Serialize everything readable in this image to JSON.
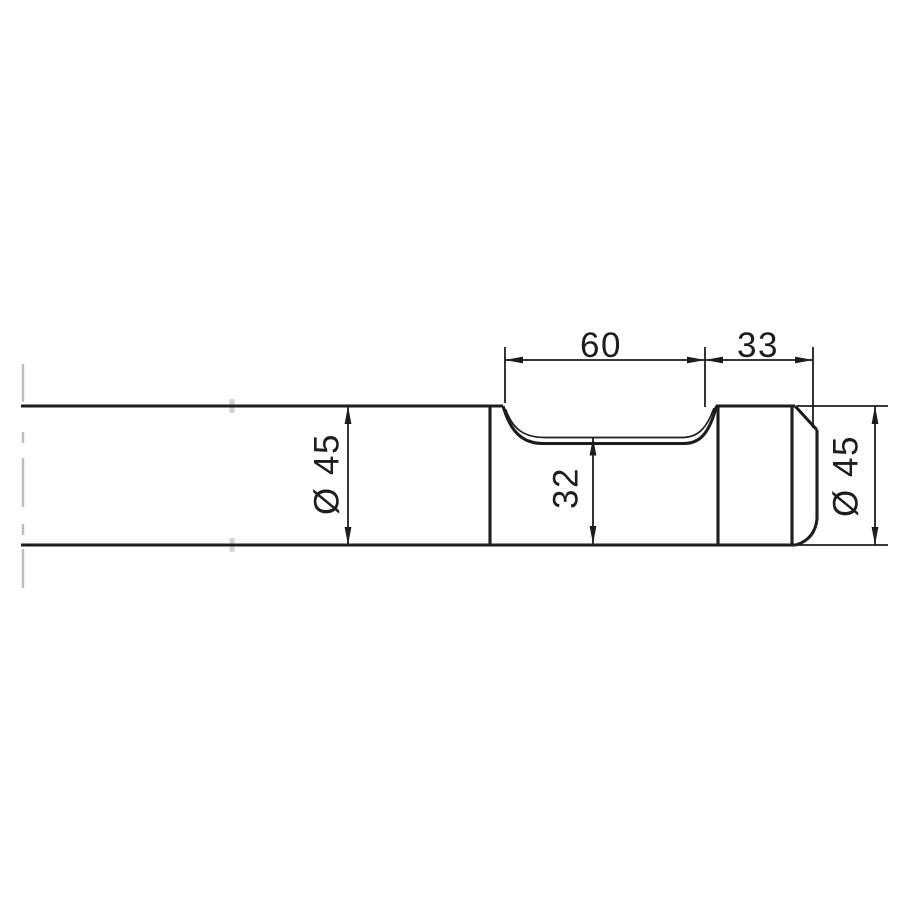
{
  "drawing": {
    "description": "Side-view technical drawing of a cylindrical tool shank with a milled retaining groove and a chamfered end collar",
    "labels": {
      "groove_length": "60",
      "end_section_length": "33",
      "shank_diameter": "Ø 45",
      "groove_diameter": "32",
      "end_diameter": "Ø 45"
    },
    "colors": {
      "line": "#1d1d1d",
      "background": "#ffffff",
      "break_line": "#bdbdbd",
      "faint_mark": "#c9c9c9"
    }
  }
}
